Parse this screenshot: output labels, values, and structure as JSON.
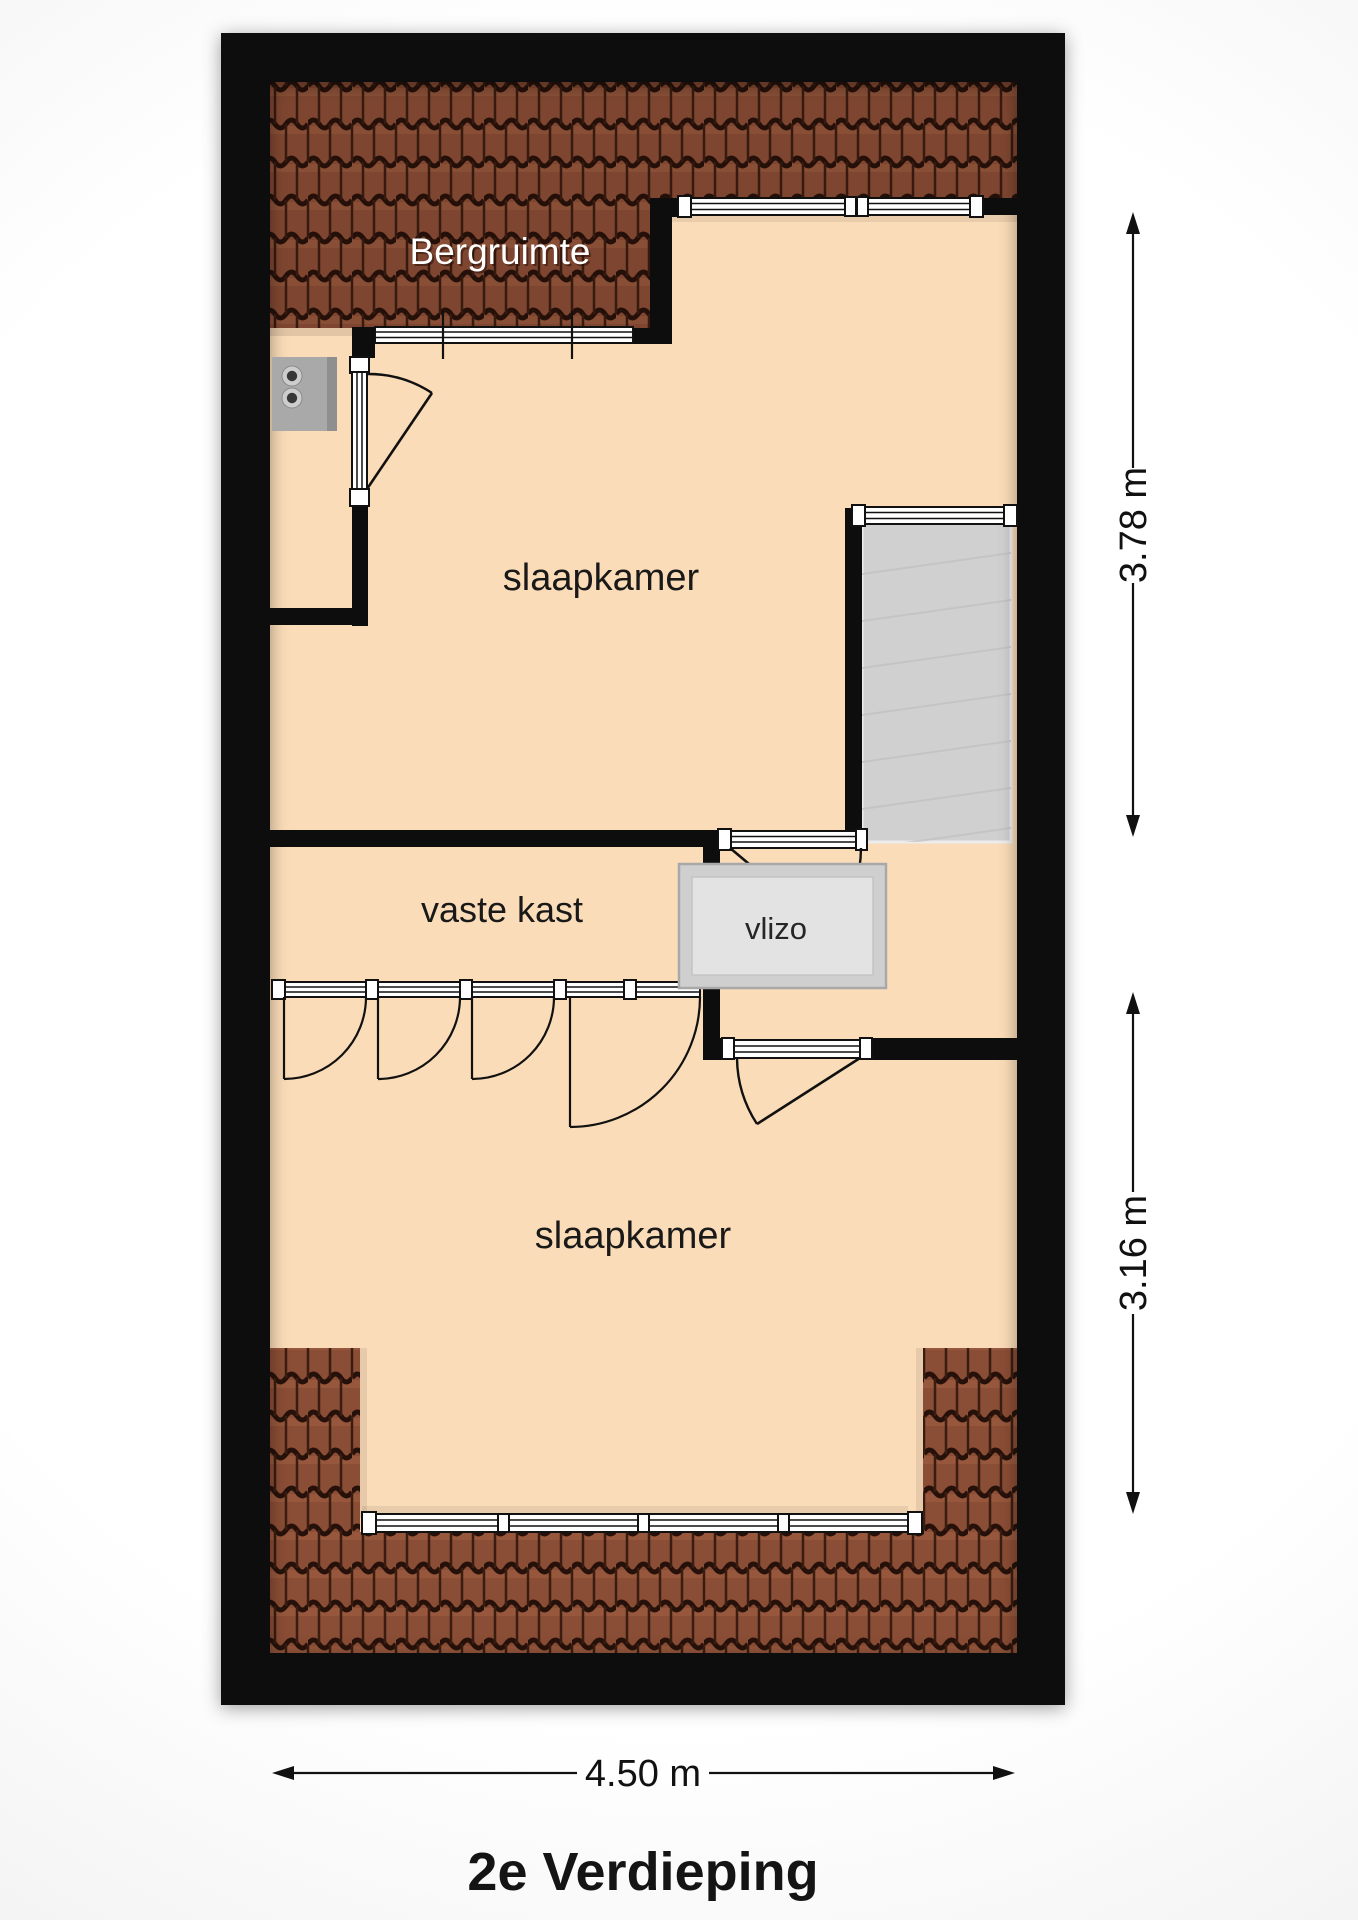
{
  "page": {
    "title": "2e Verdieping"
  },
  "rooms": {
    "bergruimte": "Bergruimte",
    "slaapkamer_boven": "slaapkamer",
    "vaste_kast": "vaste kast",
    "vlizo": "vlizo",
    "slaapkamer_onder": "slaapkamer"
  },
  "dimensions": {
    "depth_top": "3.78 m",
    "depth_bottom": "3.16 m",
    "width": "4.50 m"
  },
  "colors": {
    "wall": "#0d0d0d",
    "floor": "#fbdcb8",
    "roof_base": "#8a4d35",
    "roof_dark": "#26110a",
    "stairs": "#d0d0d0",
    "vlizo_frame": "#cfcfcf",
    "vlizo_fill": "#e3e3e3",
    "boiler": "#a9a9a9",
    "window_fill": "#ffffff"
  }
}
